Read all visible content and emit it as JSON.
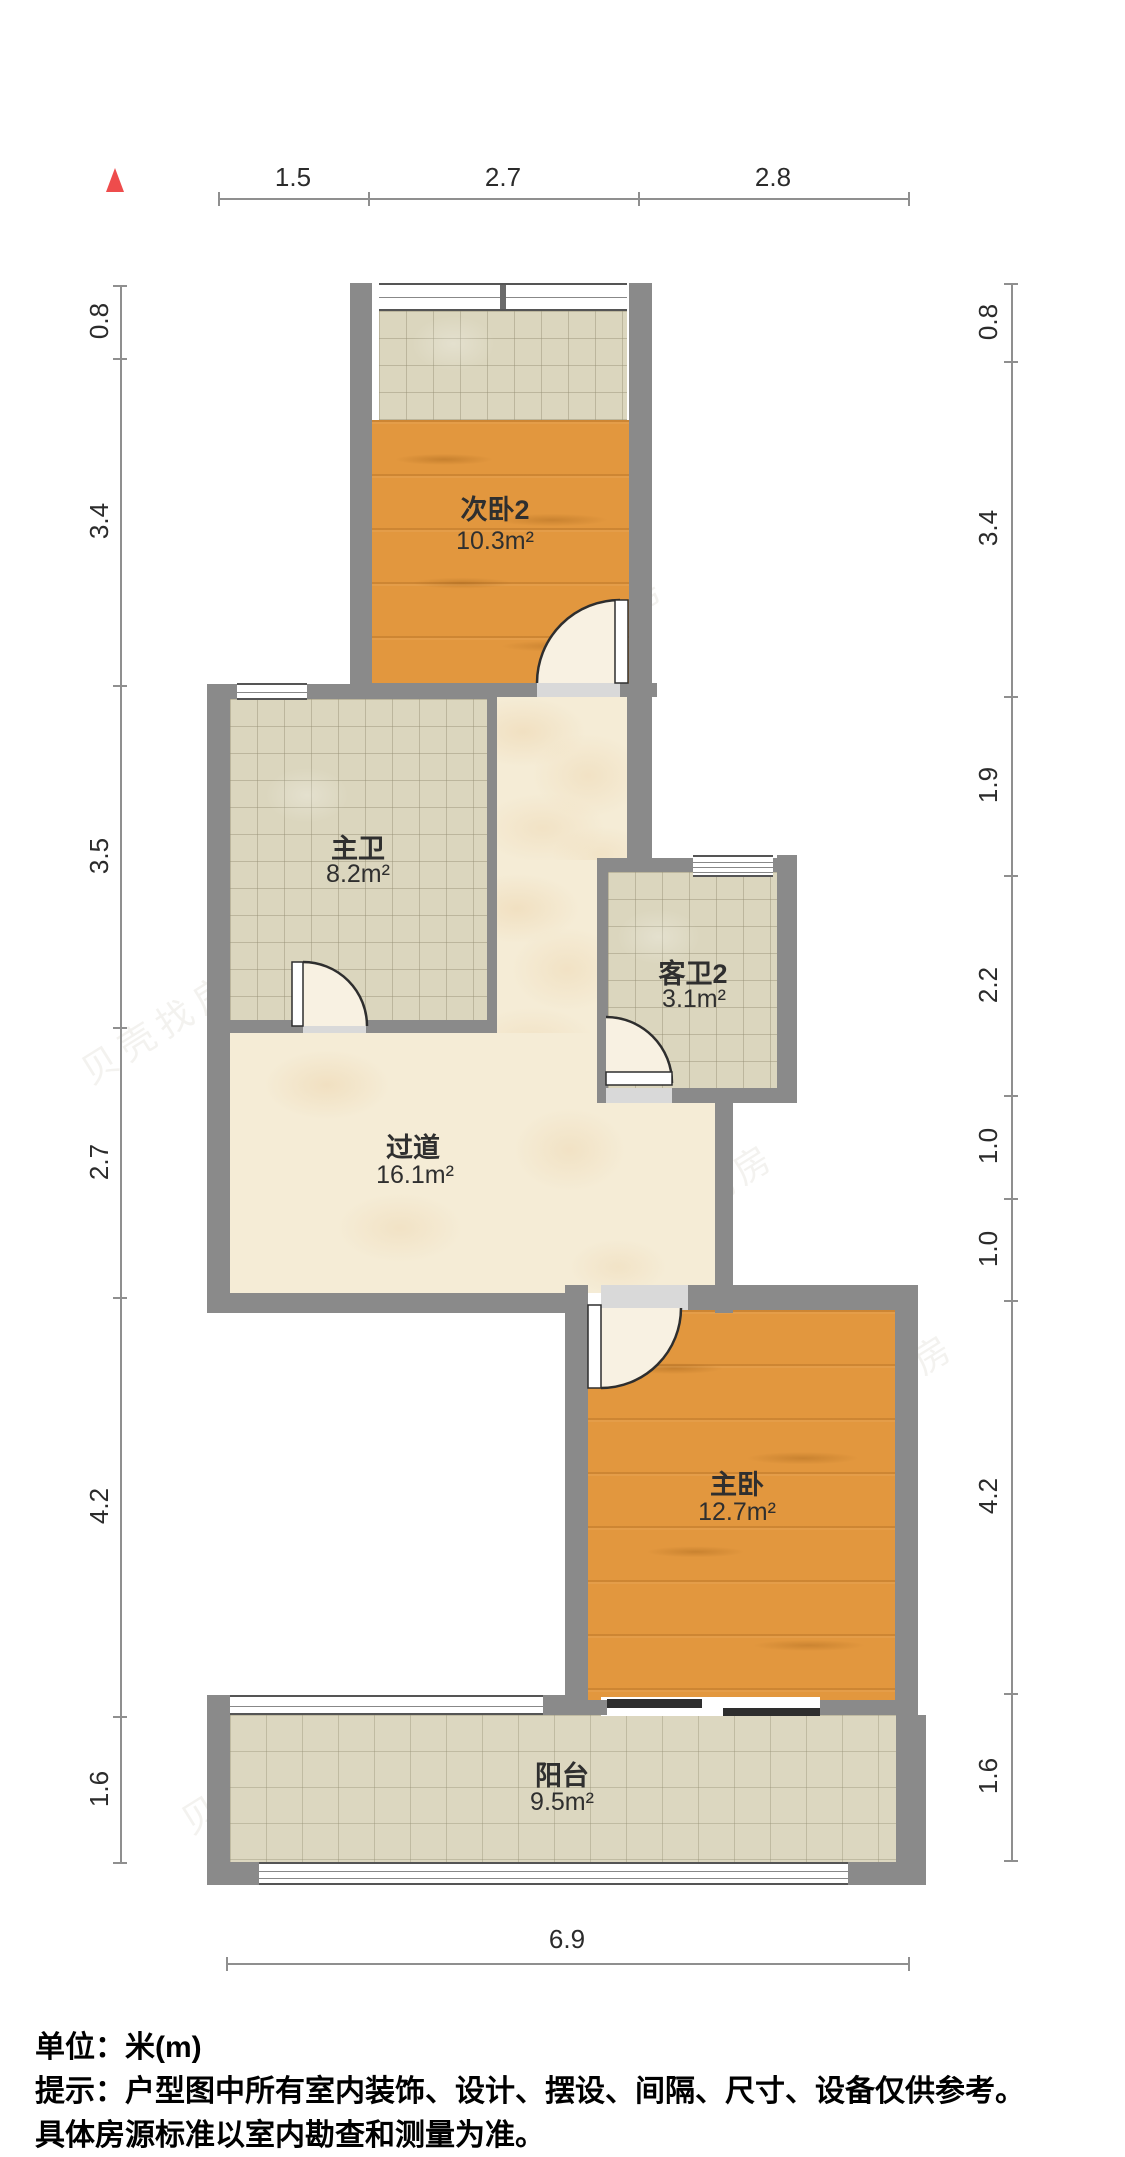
{
  "colors": {
    "wall": "#8a8a8a",
    "wood": "#e2973e",
    "tile": "#dbd6be",
    "marble": "#f5ecd6",
    "balcony": "#dcd7c0",
    "accent_north": "#ee4c4c",
    "dimension_line": "#8f8f8f",
    "label_text": "#2f2f2f"
  },
  "north_indicator": "north-arrow",
  "dimensions": {
    "top": [
      "1.5",
      "2.7",
      "2.8"
    ],
    "left": [
      "0.8",
      "3.4",
      "3.5",
      "2.7",
      "4.2",
      "1.6"
    ],
    "right": [
      "0.8",
      "3.4",
      "1.9",
      "2.2",
      "1.0",
      "1.0",
      "4.2",
      "1.6"
    ],
    "bottom": [
      "6.9"
    ]
  },
  "rooms": [
    {
      "name": "次卧2",
      "area": "10.3m²"
    },
    {
      "name": "主卫",
      "area": "8.2m²"
    },
    {
      "name": "客卫2",
      "area": "3.1m²"
    },
    {
      "name": "过道",
      "area": "16.1m²"
    },
    {
      "name": "主卧",
      "area": "12.7m²"
    },
    {
      "name": "阳台",
      "area": "9.5m²"
    }
  ],
  "notes": {
    "line1": "单位：米(m)",
    "line2": "提示：户型图中所有室内装饰、设计、摆设、间隔、尺寸、设备仅供参考。",
    "line3": "具体房源标准以室内勘查和测量为准。"
  },
  "watermark": "贝壳找房"
}
